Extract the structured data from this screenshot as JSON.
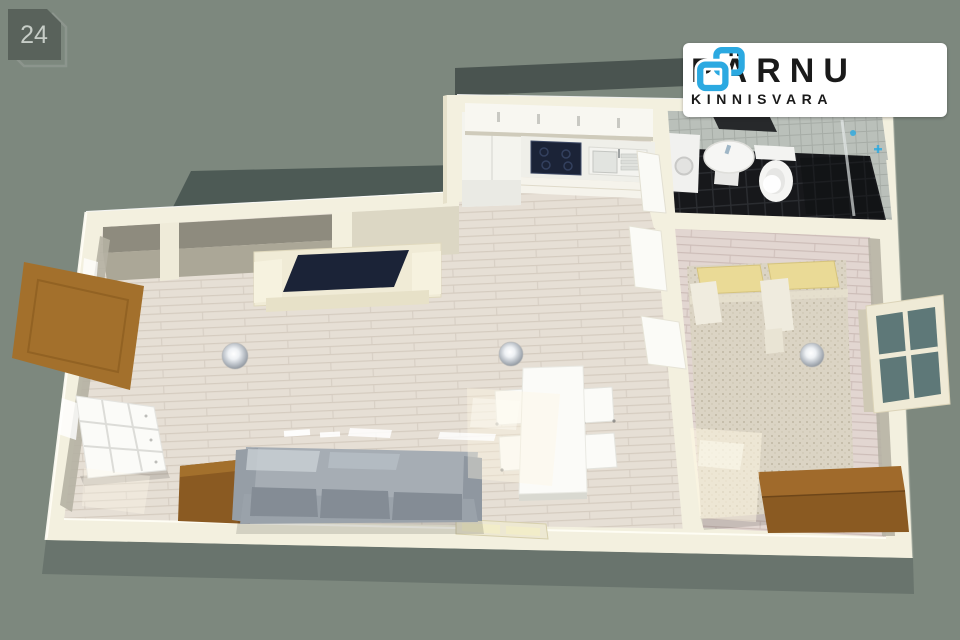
{
  "scene": {
    "type": "3d-floorplan-render",
    "rooms": [
      "living-room",
      "kitchen",
      "dining-area",
      "bathroom",
      "bedroom",
      "hallway-niche"
    ]
  },
  "logo": {
    "brand": "PÄRNU",
    "subtitle": "KINNISVARA"
  },
  "badge": {
    "number": "24"
  },
  "palette": {
    "bg": "#7D887E",
    "roof": "#4D5A55",
    "roof-dark": "#4A5450",
    "wall": "#F3F0DF",
    "wall-face": "#69746D",
    "floor": "#E6DFD5",
    "floor-line": "#D5CCC0",
    "floor-bedroom": "#E2D6D1",
    "floor-bedroom-line": "#CDBDB8",
    "tile": "#BAC0BA",
    "tile-line": "#A6ACA6",
    "bath-floor": "#17181B",
    "bath-floor-line": "#2B2D31",
    "brand": "#2BA9E1",
    "brand-text": "#1A1A1A",
    "badge-fill": "#59625B",
    "badge-outline": "#8C958D",
    "badge-text": "#C7CDC7",
    "sofa": "#9AA2AA",
    "wood": "#A3702C",
    "wood-dark": "#8A5A22",
    "tv": "#1B2337",
    "glass": "#5E7878",
    "bed": "#DBD4C4",
    "pillow": "#EADA96",
    "white-furniture": "#FBFBF8"
  }
}
